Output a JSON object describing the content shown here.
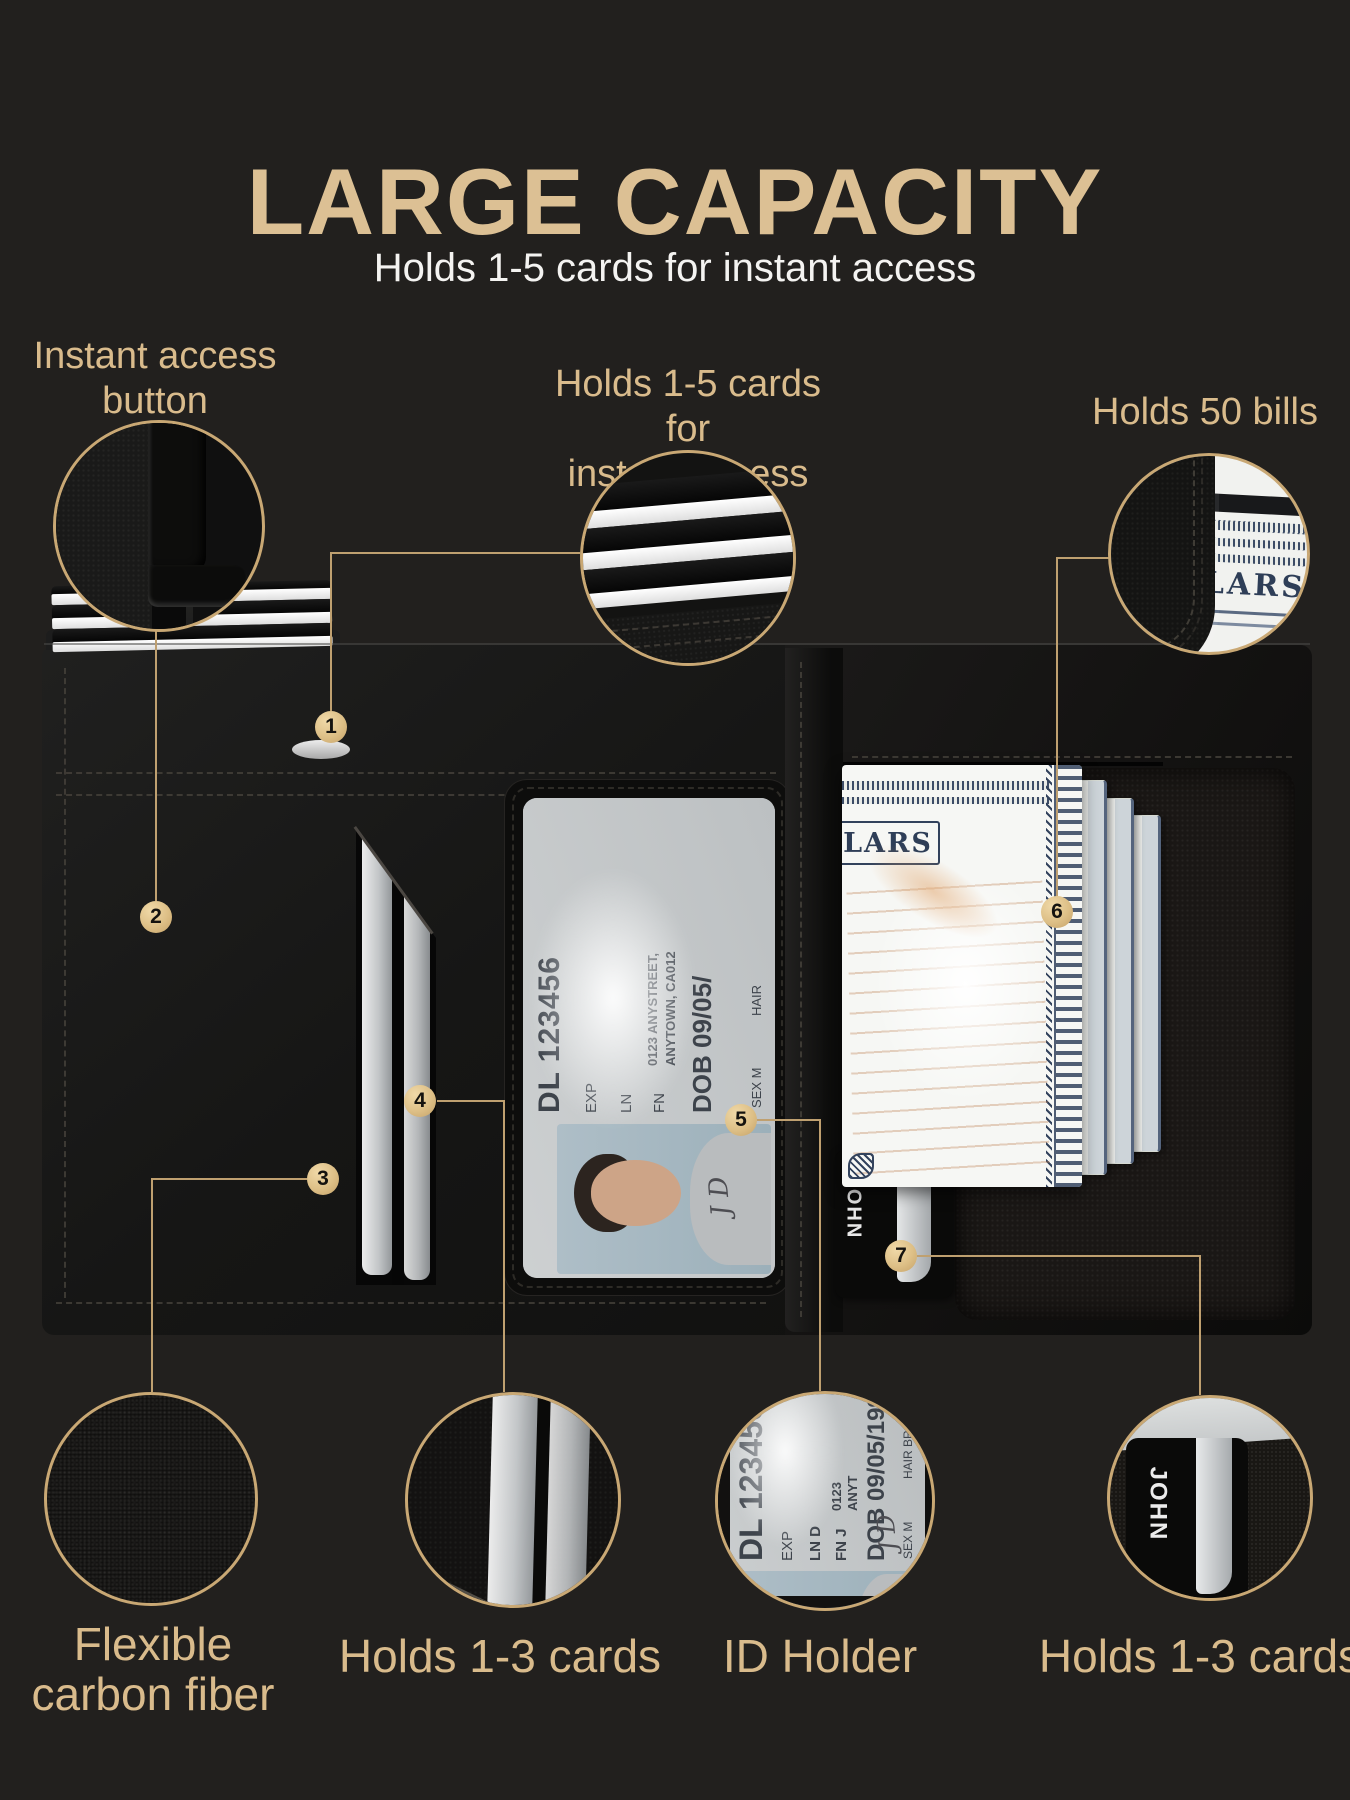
{
  "header": {
    "title": "LARGE CAPACITY",
    "subtitle": "Holds 1-5 cards for instant access"
  },
  "callouts": {
    "instant_access_button": {
      "line1": "Instant access",
      "line2": "button"
    },
    "holds_cards": {
      "line1": "Holds 1-5 cards for",
      "line2": "instant access"
    },
    "holds_bills": {
      "label": "Holds 50 bills"
    }
  },
  "markers": {
    "m1": "1",
    "m2": "2",
    "m3": "3",
    "m4": "4",
    "m5": "5",
    "m6": "6",
    "m7": "7"
  },
  "bottom_labels": {
    "carbon": {
      "line1": "Flexible",
      "line2": "carbon fiber"
    },
    "left_cards": {
      "label": "Holds 1-3 cards"
    },
    "id_holder": {
      "label": "ID Holder"
    },
    "right_cards": {
      "label": "Holds 1-3 cards"
    }
  },
  "id_card": {
    "dl": "DL 123456",
    "exp": "EXP",
    "ln": "LN",
    "fn": "FN",
    "address1": "0123 ANYSTREET,",
    "address2": "ANYTOWN, CA012",
    "dob": "DOB 09/05/",
    "sex": "SEX M",
    "hair": "HAIR",
    "signature": "J D"
  },
  "id_card_detail": {
    "dl": "DL 123456789",
    "exp": "EXP",
    "ln": "LN D",
    "fn": "FN J",
    "address1": "0123",
    "address2": "ANYT",
    "dob": "DOB 09/05/199",
    "sex": "SEX M",
    "hair": "HAIR BR",
    "signature": "J D"
  },
  "bill": {
    "denomination_text": "LARS"
  },
  "bill_detail": {
    "denomination_text": "LARS",
    "card_text": "SS"
  },
  "john_card": {
    "name": "JOHN"
  },
  "colors": {
    "background": "#22201e",
    "gold_text": "#d9bb8c",
    "gold_line": "#bfa070",
    "marker_fill": "#ddbf86"
  }
}
